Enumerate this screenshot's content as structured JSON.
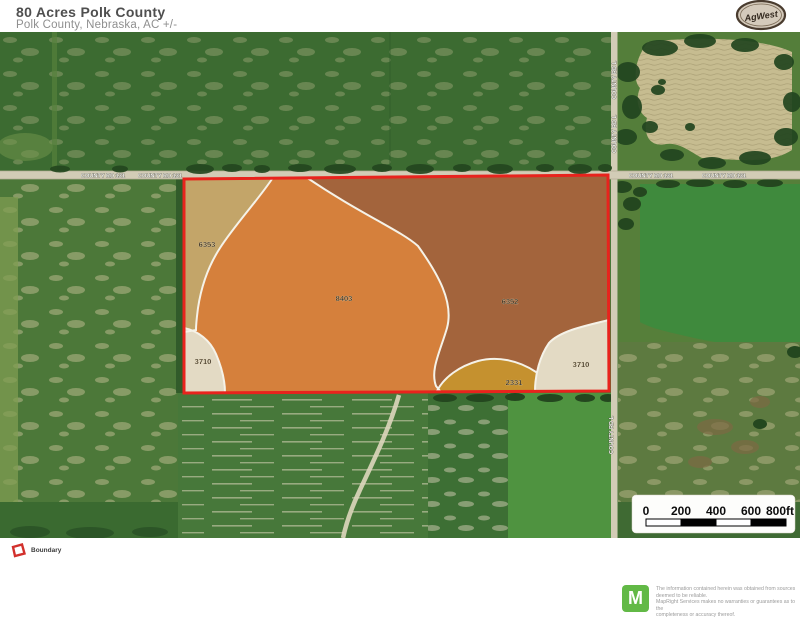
{
  "header": {
    "title": "80 Acres Polk County",
    "subtitle": "Polk County, Nebraska,  AC +/-",
    "logo_text": "AgWest"
  },
  "map": {
    "road_labels": {
      "h1": "COUNTY RD 131",
      "h2": "COUNTY RD 131",
      "h3": "COUNTY RD 131",
      "h4": "COUNTY RD 131",
      "v1": "COUNTY RD L",
      "v2": "COUNTY RD L",
      "v3": "COUNTY RD L"
    },
    "boundary_color": "#e8231d",
    "soil_zones": [
      {
        "id": "6353",
        "color": "#c3a569"
      },
      {
        "id": "8403",
        "color": "#d5803c"
      },
      {
        "id": "6352",
        "color": "#a3643c"
      },
      {
        "id": "3710",
        "color": "#e3dac4"
      },
      {
        "id": "2331",
        "color": "#c5912f"
      },
      {
        "id": "3710",
        "color": "#e3dac4"
      }
    ],
    "scale": {
      "ticks": [
        "0",
        "200",
        "400",
        "600",
        "800ft"
      ]
    }
  },
  "legend": {
    "boundary_label": "Boundary",
    "boundary_color": "#d2302c"
  },
  "footer": {
    "logo_letter": "M",
    "logo_color": "#62b946",
    "disclaimer_lines": [
      "The information contained herein was obtained from sources",
      "deemed to be reliable.",
      " MapRight Services makes no warranties or guarantees as to the",
      "completeness or accuracy thereof."
    ]
  }
}
